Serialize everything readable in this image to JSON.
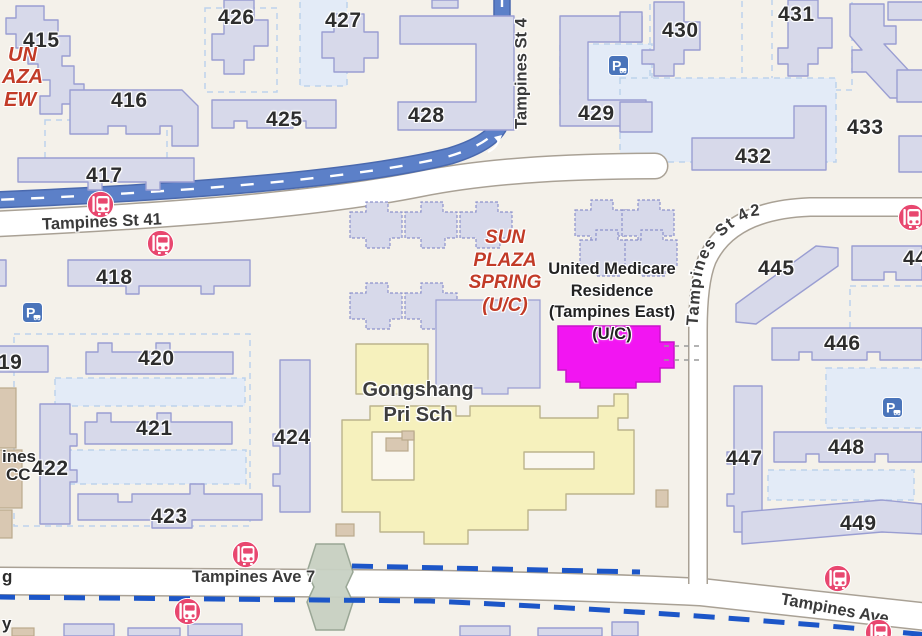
{
  "map": {
    "area": "Tampines HDB estate street map",
    "colors": {
      "background": "#f4f1ea",
      "building_fill": "#d7d9ea",
      "building_stroke": "#9a9ed2",
      "major_road_blue": "#5c80c8",
      "minor_road_white": "#ffffff",
      "school_yellow": "#f6f1bd",
      "under_construction_magenta": "#f215f2",
      "bus_stop_pink": "#e8476f",
      "parking_blue": "#4a74ba",
      "cycle_path_blue": "#1c56c8",
      "poi_red_text": "#c23b27",
      "precinct_pale_blue": "#e3ebf7",
      "bridge_green": "#c8d1c3"
    },
    "blocks": [
      "415",
      "416",
      "417",
      "418",
      "19",
      "420",
      "421",
      "422",
      "423",
      "424",
      "425",
      "426",
      "427",
      "428",
      "429",
      "430",
      "431",
      "432",
      "433",
      "445",
      "44",
      "446",
      "447",
      "448",
      "449"
    ],
    "roads": {
      "st41": "Tampines St 41",
      "st4": "Tampines St 4",
      "st42": "Tampines St 42",
      "ave7": "Tampines Ave 7",
      "ave": "Tampines Ave"
    },
    "pois": {
      "sun_plaza_spring": [
        "SUN",
        "PLAZA",
        "SPRING",
        "(U/C)"
      ],
      "united_medicare": [
        "United Medicare",
        "Residence",
        "(Tampines East)",
        "(U/C)"
      ],
      "gongshang": [
        "Gongshang",
        "Pri Sch"
      ]
    },
    "fragments": {
      "sun_plaza_view": [
        "UN",
        "AZA",
        "EW"
      ],
      "community_centre": [
        "ines",
        "CC"
      ],
      "edge": [
        "g",
        "y"
      ]
    },
    "icons": {
      "parking_glyph": "P",
      "bus_stop_icon": "bus",
      "parking_icon": "parking"
    }
  }
}
